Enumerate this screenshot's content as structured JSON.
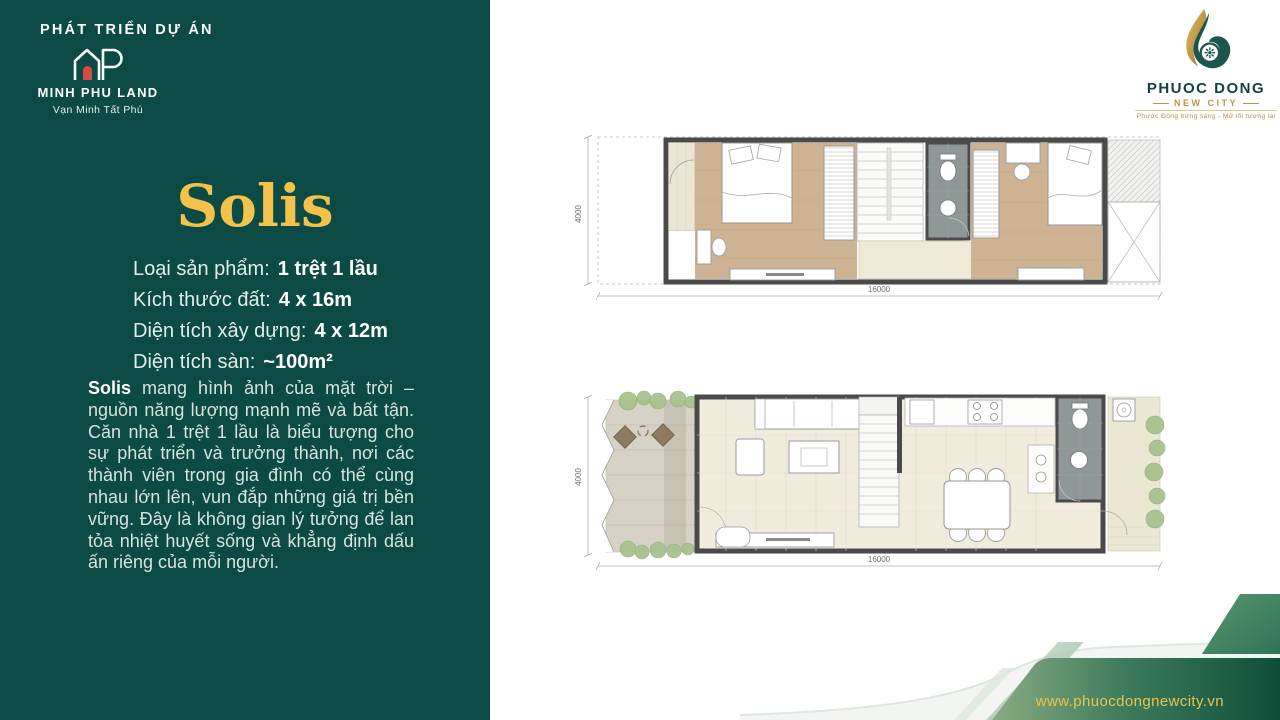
{
  "left_panel": {
    "section_label": "PHÁT TRIỂN DỰ ÁN",
    "developer": {
      "name": "MINH PHU LAND",
      "slogan": "Vạn Minh Tất Phú"
    },
    "product_title": "Solis",
    "specs": [
      {
        "label": "Loại sản phẩm:",
        "value": "1 trệt 1 lầu"
      },
      {
        "label": "Kích thước đất:",
        "value": "4 x 16m"
      },
      {
        "label": "Diện tích xây dựng:",
        "value": "4 x 12m"
      },
      {
        "label": "Diện tích sàn:",
        "value": "~100m²"
      }
    ],
    "description": {
      "lead": "Solis",
      "body": " mang hình ảnh của mặt trời – nguồn năng lượng mạnh mẽ và bất tận. Căn nhà 1 trệt 1 lầu là biểu tượng cho sự phát triển và trưởng thành, nơi các thành viên trong gia đình có thể cùng nhau lớn lên, vun đắp những giá trị bền vững. Đây là không gian lý tưởng để lan tỏa nhiệt huyết sống và khẳng định dấu ấn riêng của mỗi người."
    }
  },
  "project_logo": {
    "name": "PHUOC DONG",
    "subtitle": "NEW CITY",
    "tagline": "Phước Đông bừng sáng - Mở lối tương lai"
  },
  "floor_plans": {
    "upper": {
      "width_label": "16000",
      "depth_label": "4000"
    },
    "ground": {
      "width_label": "16000",
      "depth_label": "4000"
    }
  },
  "footer": {
    "website": "www.phuocdongnewcity.vn"
  },
  "colors": {
    "panel_green": "#0C4B45",
    "title_yellow": "#F2C24B",
    "logo_teal": "#1B564D",
    "logo_gold": "#BC9445",
    "footer_green_dark": "#0E4D39",
    "footer_gold": "#E9C44F",
    "floor_wood": "#CDB394",
    "floor_tile": "#F1EDDE",
    "wall_gray": "#4A4A4A"
  }
}
